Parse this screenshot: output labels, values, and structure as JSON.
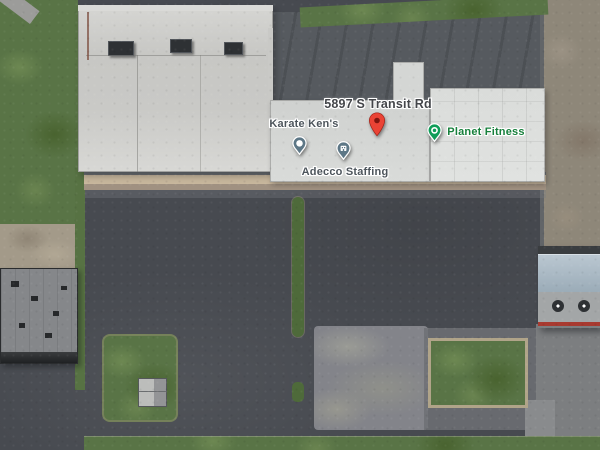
{
  "labels": {
    "address": {
      "text": "5897 S Transit Rd",
      "color": "#44464a"
    },
    "pois": [
      {
        "id": "karate-kens",
        "name": "Karate Ken's",
        "label_color": "#4d555c",
        "pin_color": "#5d7786",
        "pin_glyph": "dot"
      },
      {
        "id": "adecco-staffing",
        "name": "Adecco Staffing",
        "label_color": "#4d555c",
        "pin_color": "#5d7786",
        "pin_glyph": "building"
      },
      {
        "id": "planet-fitness",
        "name": "Planet Fitness",
        "label_color": "#17803c",
        "pin_color": "#0f9d58",
        "pin_glyph": "ring"
      }
    ],
    "marker": {
      "color": "#ea4335",
      "inner_color": "#7e150f"
    }
  },
  "scatter": {
    "stripes": [
      {
        "x": 88,
        "y": 196,
        "w": 200,
        "h": 10,
        "o": "v"
      },
      {
        "x": 88,
        "y": 220,
        "w": 200,
        "h": 10,
        "o": "v"
      },
      {
        "x": 88,
        "y": 246,
        "w": 200,
        "h": 10,
        "o": "v"
      },
      {
        "x": 88,
        "y": 272,
        "w": 200,
        "h": 10,
        "o": "v"
      },
      {
        "x": 88,
        "y": 298,
        "w": 200,
        "h": 10,
        "o": "v"
      },
      {
        "x": 88,
        "y": 324,
        "w": 200,
        "h": 10,
        "o": "v"
      },
      {
        "x": 88,
        "y": 350,
        "w": 200,
        "h": 10,
        "o": "v"
      },
      {
        "x": 88,
        "y": 376,
        "w": 200,
        "h": 10,
        "o": "v"
      },
      {
        "x": 88,
        "y": 402,
        "w": 200,
        "h": 10,
        "o": "v"
      },
      {
        "x": 0,
        "y": 424,
        "w": 90,
        "h": 8,
        "o": "v"
      },
      {
        "x": 306,
        "y": 196,
        "w": 232,
        "h": 10,
        "o": "v"
      },
      {
        "x": 306,
        "y": 220,
        "w": 232,
        "h": 10,
        "o": "v"
      },
      {
        "x": 306,
        "y": 246,
        "w": 232,
        "h": 10,
        "o": "v"
      },
      {
        "x": 306,
        "y": 272,
        "w": 232,
        "h": 10,
        "o": "v"
      },
      {
        "x": 306,
        "y": 298,
        "w": 230,
        "h": 10,
        "o": "v"
      },
      {
        "x": 320,
        "y": 420,
        "w": 180,
        "h": 8,
        "o": "v"
      },
      {
        "x": 548,
        "y": 424,
        "w": 52,
        "h": 8,
        "o": "v"
      },
      {
        "x": 500,
        "y": 238,
        "w": 34,
        "h": 92,
        "o": "h"
      }
    ],
    "cars": [
      {
        "x": 317,
        "y": 80,
        "w": 12,
        "h": 6,
        "c": "#2b2e31"
      },
      {
        "x": 330,
        "y": 82,
        "w": 6,
        "h": 10,
        "c": "#d9d9d7"
      },
      {
        "x": 137,
        "y": 196,
        "w": 5,
        "h": 10,
        "c": "#d8d8d6"
      },
      {
        "x": 148,
        "y": 195,
        "w": 5,
        "h": 10,
        "c": "#2e3134"
      },
      {
        "x": 160,
        "y": 196,
        "w": 5,
        "h": 10,
        "c": "#c9c9c7"
      },
      {
        "x": 172,
        "y": 195,
        "w": 5,
        "h": 10,
        "c": "#8e9092"
      },
      {
        "x": 236,
        "y": 195,
        "w": 5,
        "h": 10,
        "c": "#d8d8d6"
      },
      {
        "x": 247,
        "y": 196,
        "w": 5,
        "h": 10,
        "c": "#303437"
      },
      {
        "x": 258,
        "y": 195,
        "w": 5,
        "h": 10,
        "c": "#cfcfcd"
      },
      {
        "x": 270,
        "y": 196,
        "w": 5,
        "h": 10,
        "c": "#94969a"
      },
      {
        "x": 310,
        "y": 195,
        "w": 5,
        "h": 10,
        "c": "#d8d8d6"
      },
      {
        "x": 321,
        "y": 196,
        "w": 5,
        "h": 10,
        "c": "#2c2f33"
      },
      {
        "x": 332,
        "y": 195,
        "w": 5,
        "h": 10,
        "c": "#c4c6c8"
      },
      {
        "x": 352,
        "y": 196,
        "w": 5,
        "h": 10,
        "c": "#d6d6d4"
      },
      {
        "x": 363,
        "y": 195,
        "w": 5,
        "h": 10,
        "c": "#3a3e42"
      },
      {
        "x": 375,
        "y": 196,
        "w": 5,
        "h": 10,
        "c": "#8b8d90"
      },
      {
        "x": 386,
        "y": 195,
        "w": 5,
        "h": 10,
        "c": "#dadad8"
      },
      {
        "x": 407,
        "y": 195,
        "w": 5,
        "h": 10,
        "c": "#d0d0ce"
      },
      {
        "x": 418,
        "y": 196,
        "w": 5,
        "h": 10,
        "c": "#35383c"
      },
      {
        "x": 455,
        "y": 195,
        "w": 5,
        "h": 10,
        "c": "#d9d9d7"
      },
      {
        "x": 466,
        "y": 196,
        "w": 5,
        "h": 10,
        "c": "#2f3236"
      },
      {
        "x": 478,
        "y": 195,
        "w": 5,
        "h": 10,
        "c": "#c9cbcd"
      },
      {
        "x": 520,
        "y": 195,
        "w": 5,
        "h": 10,
        "c": "#d4d4d2"
      },
      {
        "x": 531,
        "y": 196,
        "w": 5,
        "h": 10,
        "c": "#707274"
      },
      {
        "x": 133,
        "y": 220,
        "w": 5,
        "h": 10,
        "c": "#303336"
      },
      {
        "x": 145,
        "y": 221,
        "w": 5,
        "h": 10,
        "c": "#85878a"
      },
      {
        "x": 158,
        "y": 220,
        "w": 5,
        "h": 10,
        "c": "#2b2e31"
      },
      {
        "x": 240,
        "y": 221,
        "w": 5,
        "h": 10,
        "c": "#2f3235"
      },
      {
        "x": 252,
        "y": 220,
        "w": 5,
        "h": 10,
        "c": "#9a9c9e"
      },
      {
        "x": 310,
        "y": 229,
        "w": 5,
        "h": 10,
        "c": "#2d3034"
      },
      {
        "x": 322,
        "y": 230,
        "w": 5,
        "h": 10,
        "c": "#808284"
      },
      {
        "x": 335,
        "y": 229,
        "w": 5,
        "h": 10,
        "c": "#d8d8d6"
      },
      {
        "x": 410,
        "y": 227,
        "w": 5,
        "h": 10,
        "c": "#d5d5d3"
      },
      {
        "x": 422,
        "y": 228,
        "w": 5,
        "h": 10,
        "c": "#303336"
      },
      {
        "x": 458,
        "y": 228,
        "w": 5,
        "h": 10,
        "c": "#2e3134"
      },
      {
        "x": 470,
        "y": 227,
        "w": 5,
        "h": 10,
        "c": "#d7d7d5"
      },
      {
        "x": 523,
        "y": 227,
        "w": 5,
        "h": 10,
        "c": "#d3d3d1"
      },
      {
        "x": 148,
        "y": 247,
        "w": 5,
        "h": 10,
        "c": "#313437"
      },
      {
        "x": 174,
        "y": 248,
        "w": 5,
        "h": 10,
        "c": "#8f9193"
      },
      {
        "x": 250,
        "y": 246,
        "w": 5,
        "h": 10,
        "c": "#d8d8d6"
      },
      {
        "x": 264,
        "y": 247,
        "w": 5,
        "h": 10,
        "c": "#2e3134"
      },
      {
        "x": 180,
        "y": 252,
        "w": 16,
        "h": 7,
        "c": "#6d2a31"
      },
      {
        "x": 325,
        "y": 257,
        "w": 16,
        "h": 7,
        "c": "#dcdcda"
      },
      {
        "x": 415,
        "y": 252,
        "w": 5,
        "h": 10,
        "c": "#2f3236"
      },
      {
        "x": 462,
        "y": 250,
        "w": 5,
        "h": 10,
        "c": "#87898b"
      },
      {
        "x": 538,
        "y": 252,
        "w": 5,
        "h": 10,
        "c": "#2e3134"
      },
      {
        "x": 178,
        "y": 275,
        "w": 5,
        "h": 10,
        "c": "#303336"
      },
      {
        "x": 262,
        "y": 276,
        "w": 5,
        "h": 10,
        "c": "#d6d6d4"
      },
      {
        "x": 318,
        "y": 283,
        "w": 5,
        "h": 10,
        "c": "#2c2f32"
      },
      {
        "x": 342,
        "y": 285,
        "w": 5,
        "h": 10,
        "c": "#303437"
      },
      {
        "x": 400,
        "y": 266,
        "w": 18,
        "h": 7,
        "c": "#dcdcda"
      },
      {
        "x": 525,
        "y": 280,
        "w": 5,
        "h": 10,
        "c": "#2f3235"
      },
      {
        "x": 538,
        "y": 297,
        "w": 5,
        "h": 10,
        "c": "#323639"
      },
      {
        "x": 3,
        "y": 362,
        "w": 6,
        "h": 13,
        "c": "#d9d9d7"
      },
      {
        "x": 11,
        "y": 362,
        "w": 6,
        "h": 13,
        "c": "#2e3134"
      },
      {
        "x": 19,
        "y": 362,
        "w": 6,
        "h": 13,
        "c": "#d9d9d7"
      },
      {
        "x": 27,
        "y": 363,
        "w": 6,
        "h": 13,
        "c": "#dcdcda"
      },
      {
        "x": 37,
        "y": 362,
        "w": 6,
        "h": 13,
        "c": "#caccce"
      },
      {
        "x": 46,
        "y": 362,
        "w": 6,
        "h": 13,
        "c": "#d9d9d7"
      },
      {
        "x": 56,
        "y": 362,
        "w": 6,
        "h": 13,
        "c": "#35383b"
      },
      {
        "x": 65,
        "y": 362,
        "w": 6,
        "h": 13,
        "c": "#d9d9d7"
      },
      {
        "x": 7,
        "y": 391,
        "w": 6,
        "h": 12,
        "c": "#30343a"
      },
      {
        "x": 15,
        "y": 391,
        "w": 6,
        "h": 12,
        "c": "#6b7075"
      },
      {
        "x": 23,
        "y": 390,
        "w": 6,
        "h": 12,
        "c": "#23262a"
      },
      {
        "x": 31,
        "y": 391,
        "w": 6,
        "h": 12,
        "c": "#5d2430"
      },
      {
        "x": 39,
        "y": 390,
        "w": 6,
        "h": 12,
        "c": "#2b2f34"
      },
      {
        "x": 47,
        "y": 391,
        "w": 6,
        "h": 12,
        "c": "#93979b"
      },
      {
        "x": 55,
        "y": 390,
        "w": 6,
        "h": 12,
        "c": "#303437"
      },
      {
        "x": 63,
        "y": 391,
        "w": 6,
        "h": 12,
        "c": "#7c2430"
      },
      {
        "x": 71,
        "y": 390,
        "w": 6,
        "h": 12,
        "c": "#d8d8d6"
      },
      {
        "x": 9,
        "y": 426,
        "w": 6,
        "h": 12,
        "c": "#702428"
      },
      {
        "x": 19,
        "y": 433,
        "w": 6,
        "h": 11,
        "c": "#d8d8d6"
      },
      {
        "x": 2,
        "y": 437,
        "w": 6,
        "h": 11,
        "c": "#2c2f33"
      },
      {
        "x": 29,
        "y": 439,
        "w": 5,
        "h": 9,
        "c": "#8b8d8f"
      },
      {
        "x": 541,
        "y": 232,
        "w": 5,
        "h": 9,
        "c": "#a03830"
      },
      {
        "x": 543,
        "y": 332,
        "w": 5,
        "h": 9,
        "c": "#8c2a28"
      },
      {
        "x": 578,
        "y": 337,
        "w": 8,
        "h": 5,
        "c": "#303336"
      },
      {
        "x": 553,
        "y": 363,
        "w": 8,
        "h": 13,
        "c": "#e8e8e6"
      },
      {
        "x": 577,
        "y": 366,
        "w": 10,
        "h": 5,
        "c": "#2f3236"
      },
      {
        "x": 571,
        "y": 418,
        "w": 15,
        "h": 6,
        "c": "#e3e3e1"
      },
      {
        "x": 462,
        "y": 403,
        "w": 26,
        "h": 7,
        "c": "#e6e6e4"
      },
      {
        "x": 159,
        "y": 400,
        "w": 4,
        "h": 4,
        "c": "#b23a2e"
      },
      {
        "x": 173,
        "y": 430,
        "w": 6,
        "h": 10,
        "c": "#3a3e42"
      },
      {
        "x": 516,
        "y": 418,
        "w": 6,
        "h": 10,
        "c": "#303336"
      }
    ],
    "trees": [
      {
        "x": 12,
        "y": 40,
        "r": 14
      },
      {
        "x": 38,
        "y": 72,
        "r": 20
      },
      {
        "x": 58,
        "y": 28,
        "r": 12
      },
      {
        "x": 18,
        "y": 118,
        "r": 18
      },
      {
        "x": 46,
        "y": 158,
        "r": 16
      },
      {
        "x": 10,
        "y": 190,
        "r": 12
      },
      {
        "x": 62,
        "y": 200,
        "r": 10
      },
      {
        "x": 30,
        "y": 210,
        "r": 12
      },
      {
        "x": 558,
        "y": 8,
        "r": 13
      },
      {
        "x": 580,
        "y": 18,
        "r": 16
      },
      {
        "x": 596,
        "y": 38,
        "r": 11
      },
      {
        "x": 568,
        "y": 36,
        "r": 9
      },
      {
        "x": 298,
        "y": 212,
        "r": 7
      },
      {
        "x": 298,
        "y": 238,
        "r": 6
      },
      {
        "x": 298,
        "y": 264,
        "r": 7
      },
      {
        "x": 298,
        "y": 292,
        "r": 6
      },
      {
        "x": 298,
        "y": 318,
        "r": 7
      },
      {
        "x": 298,
        "y": 390,
        "r": 6
      },
      {
        "x": 437,
        "y": 347,
        "r": 9
      },
      {
        "x": 513,
        "y": 349,
        "r": 10
      },
      {
        "x": 442,
        "y": 390,
        "r": 8
      },
      {
        "x": 508,
        "y": 396,
        "r": 9
      },
      {
        "x": 470,
        "y": 341,
        "r": 6
      },
      {
        "x": 523,
        "y": 352,
        "r": 8
      },
      {
        "x": 516,
        "y": 402,
        "r": 7
      },
      {
        "x": 112,
        "y": 350,
        "r": 8
      },
      {
        "x": 150,
        "y": 366,
        "r": 11
      },
      {
        "x": 128,
        "y": 342,
        "r": 7
      },
      {
        "x": 108,
        "y": 400,
        "r": 7
      },
      {
        "x": 300,
        "y": 446,
        "r": 6
      },
      {
        "x": 352,
        "y": 441,
        "r": 8
      },
      {
        "x": 394,
        "y": 444,
        "r": 7
      },
      {
        "x": 560,
        "y": 441,
        "r": 8
      },
      {
        "x": 588,
        "y": 446,
        "r": 7
      },
      {
        "x": 520,
        "y": 444,
        "r": 6
      },
      {
        "x": 287,
        "y": 404,
        "r": 6
      },
      {
        "x": 314,
        "y": 404,
        "r": 6
      },
      {
        "x": 80,
        "y": 250,
        "r": 5
      },
      {
        "x": 80,
        "y": 300,
        "r": 6
      },
      {
        "x": 80,
        "y": 340,
        "r": 5
      },
      {
        "x": 93,
        "y": 215,
        "r": 6
      }
    ],
    "blobs": [
      {
        "x": 100,
        "y": 62,
        "r": 8,
        "c": "#8a6243"
      },
      {
        "x": 96,
        "y": 118,
        "r": 10,
        "c": "#936b49"
      },
      {
        "x": 143,
        "y": 137,
        "r": 7,
        "c": "#8a6243"
      },
      {
        "x": 230,
        "y": 150,
        "r": 5,
        "c": "#8a6243"
      },
      {
        "x": 118,
        "y": 30,
        "r": 5,
        "c": "#7d5a3e"
      },
      {
        "x": 356,
        "y": 120,
        "r": 4,
        "c": "#9a7450"
      },
      {
        "x": 300,
        "y": 150,
        "r": 4,
        "c": "#8a6243"
      },
      {
        "x": 556,
        "y": 80,
        "r": 12,
        "c": "#7b6f5e"
      },
      {
        "x": 576,
        "y": 122,
        "r": 16,
        "c": "#857463"
      },
      {
        "x": 562,
        "y": 170,
        "r": 14,
        "c": "#7b6f5e"
      },
      {
        "x": 586,
        "y": 212,
        "r": 12,
        "c": "#8a7d6a"
      },
      {
        "x": 590,
        "y": 60,
        "r": 10,
        "c": "#7b6f5e"
      },
      {
        "x": 572,
        "y": 232,
        "r": 10,
        "c": "#73675a"
      }
    ],
    "vents": [
      {
        "x": 300,
        "y": 128
      },
      {
        "x": 320,
        "y": 150
      },
      {
        "x": 350,
        "y": 132
      },
      {
        "x": 368,
        "y": 158
      },
      {
        "x": 388,
        "y": 126
      },
      {
        "x": 412,
        "y": 148
      },
      {
        "x": 430,
        "y": 120
      },
      {
        "x": 452,
        "y": 104
      },
      {
        "x": 470,
        "y": 130
      },
      {
        "x": 492,
        "y": 112
      },
      {
        "x": 508,
        "y": 146
      },
      {
        "x": 522,
        "y": 100
      },
      {
        "x": 533,
        "y": 130
      },
      {
        "x": 460,
        "y": 160
      },
      {
        "x": 432,
        "y": 165
      },
      {
        "x": 490,
        "y": 160
      },
      {
        "x": 540,
        "y": 158
      },
      {
        "x": 302,
        "y": 168
      },
      {
        "x": 340,
        "y": 168
      },
      {
        "x": 375,
        "y": 110
      },
      {
        "x": 405,
        "y": 95
      },
      {
        "x": 440,
        "y": 95
      },
      {
        "x": 480,
        "y": 95
      },
      {
        "x": 515,
        "y": 92
      },
      {
        "x": 300,
        "y": 112
      },
      {
        "x": 330,
        "y": 115
      }
    ]
  }
}
